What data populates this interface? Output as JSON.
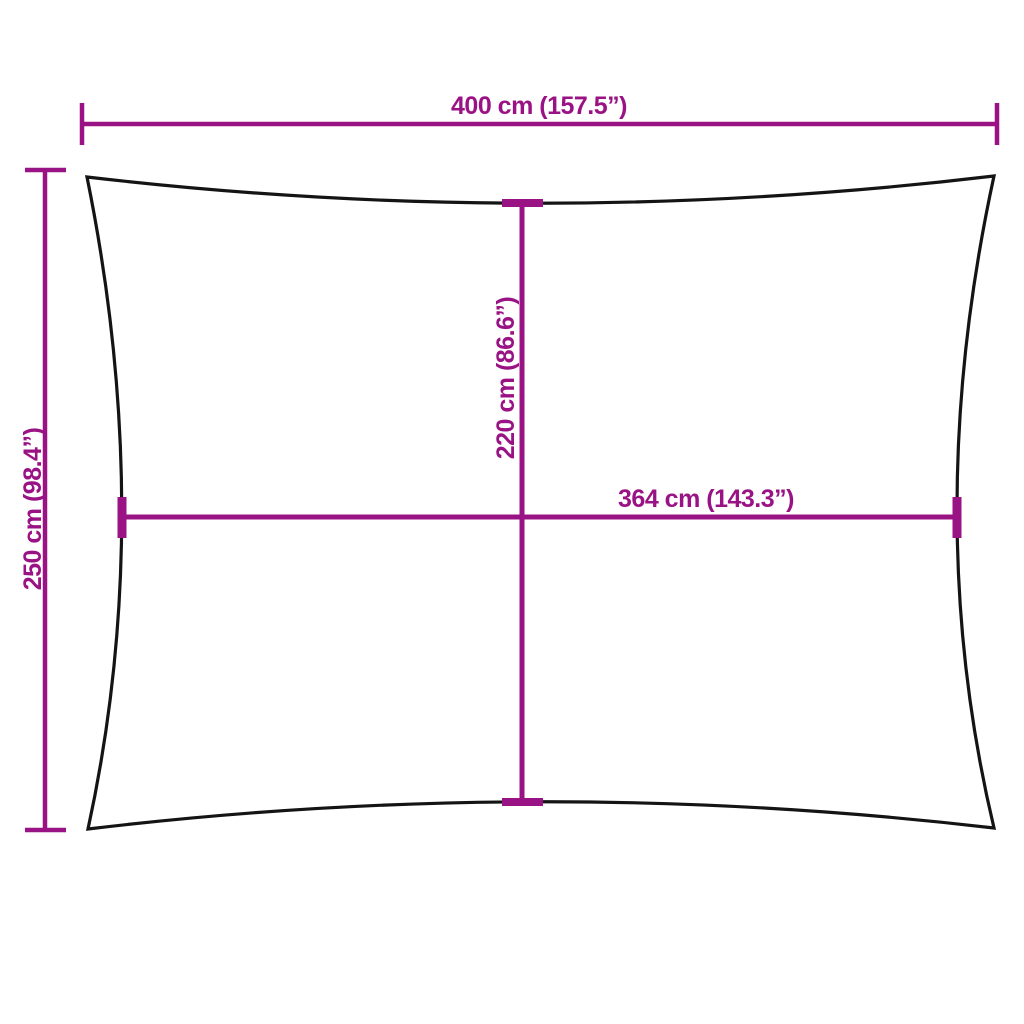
{
  "colors": {
    "dimension": "#9A1385",
    "outline": "#141414",
    "background": "#FFFFFF"
  },
  "dimensions": {
    "top_width": "400 cm (157.5”)",
    "left_height": "250 cm (98.4”)",
    "center_height": "220 cm (86.6”)",
    "center_width": "364 cm (143.3”)"
  }
}
